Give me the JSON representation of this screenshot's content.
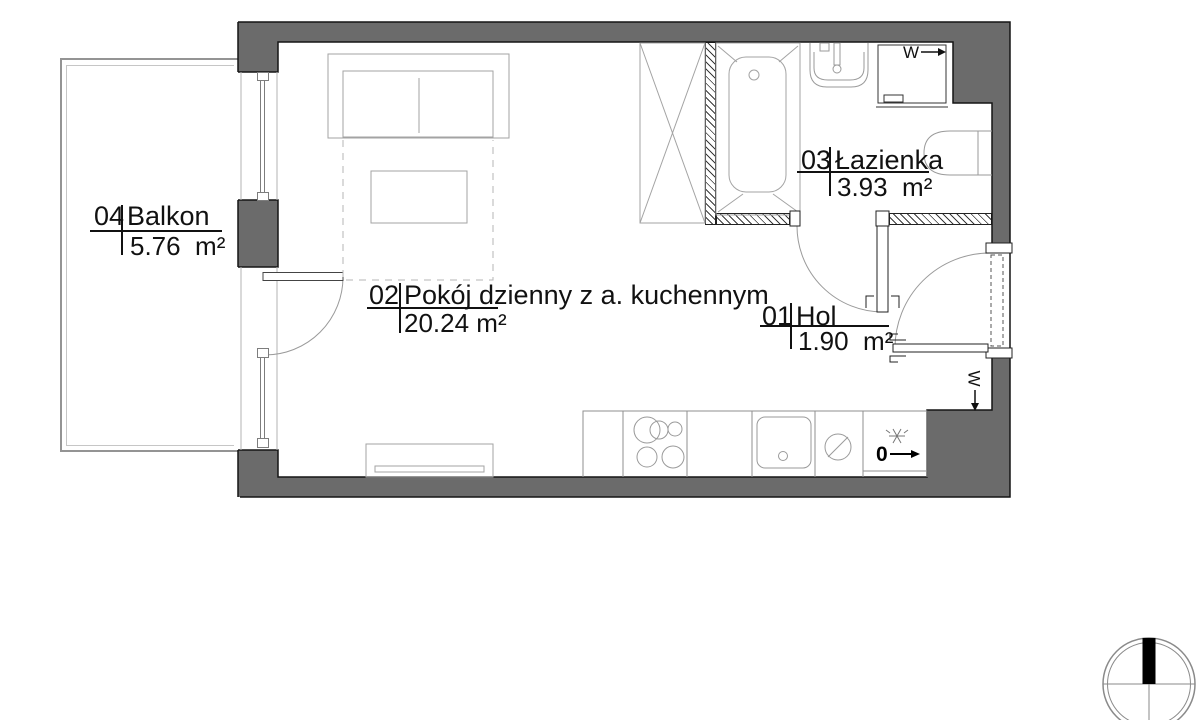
{
  "rooms": [
    {
      "number": "01",
      "name": "Hol",
      "area": "1.90  m²"
    },
    {
      "number": "02",
      "name": "Pokój dzienny z a. kuchennym",
      "area": "20.24 m²"
    },
    {
      "number": "03",
      "name": "Łazienka",
      "area": "3.93  m²"
    },
    {
      "number": "04",
      "name": "Balkon",
      "area": "5.76  m²"
    }
  ],
  "markers": {
    "washer": "W",
    "vent": "W",
    "fridge": "0"
  },
  "colors": {
    "wall": "#6b6b6b",
    "hatch_line": "#3a3a3a",
    "furniture_line": "#a3a3a3",
    "text": "#111111"
  }
}
